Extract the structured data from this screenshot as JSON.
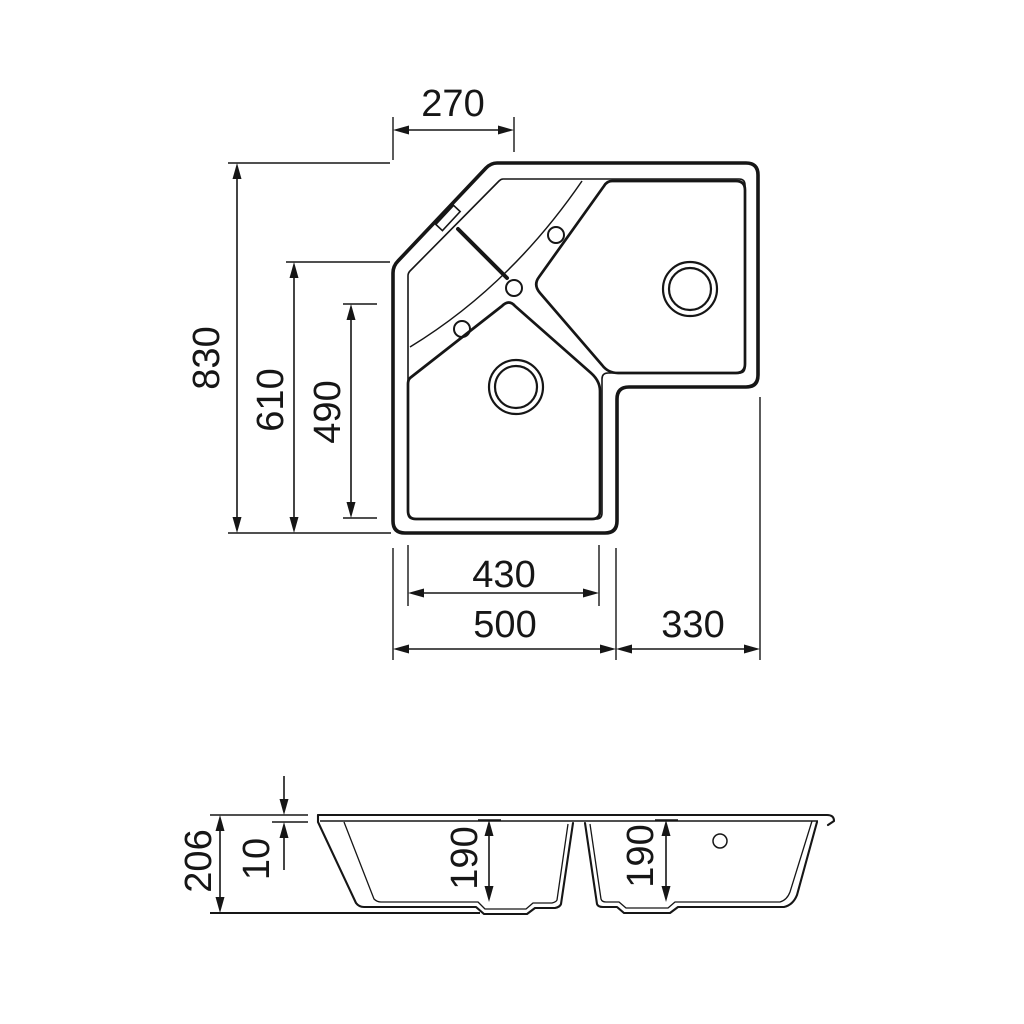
{
  "colors": {
    "background": "#ffffff",
    "ink": "#161616"
  },
  "top_view": {
    "label": "plan-view",
    "dims": {
      "corner_width": "270",
      "overall_depth": "830",
      "left_edge_depth": "610",
      "bowl_depth": "490",
      "bowl_width": "430",
      "left_section_width": "500",
      "right_section_width": "330"
    }
  },
  "section_view": {
    "label": "section-view",
    "dims": {
      "overall_height": "206",
      "rim_height": "10",
      "left_bowl_depth": "190",
      "right_bowl_depth": "190"
    }
  }
}
